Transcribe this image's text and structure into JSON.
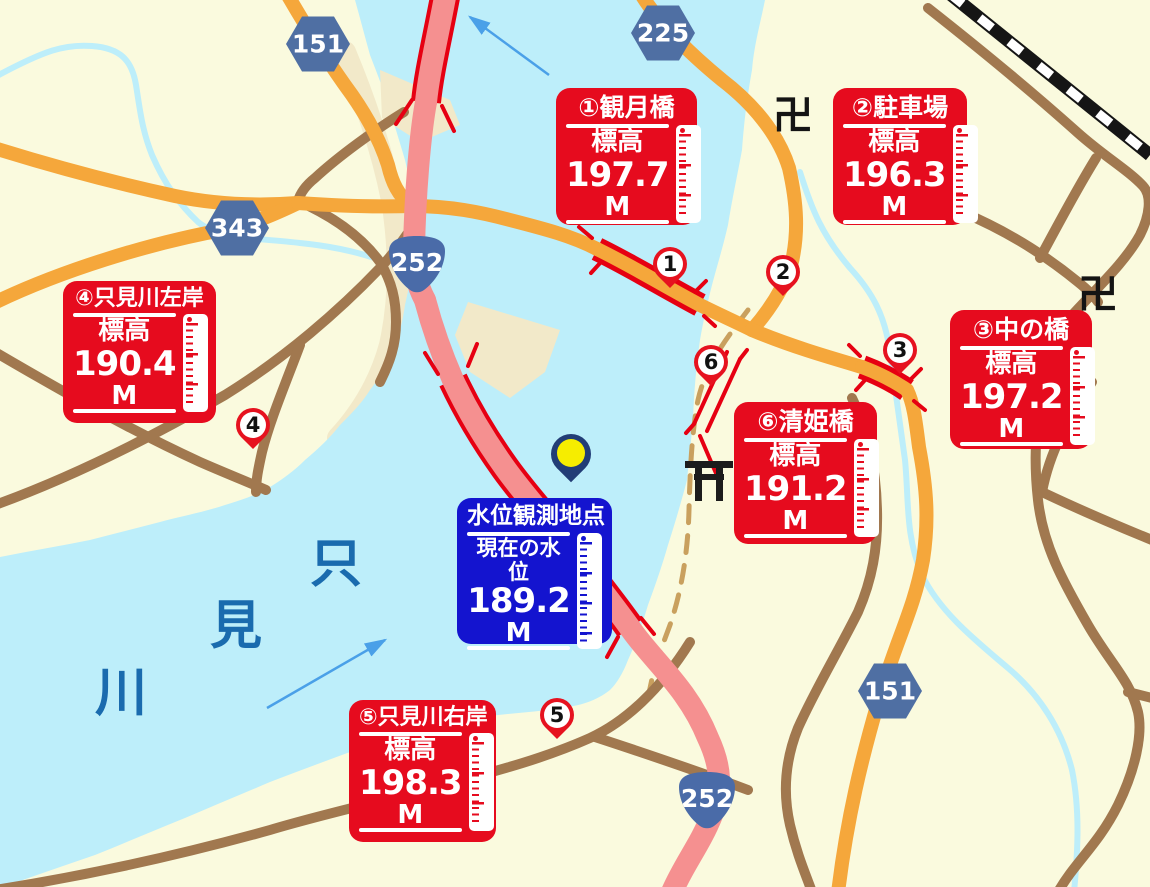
{
  "legend": {
    "stations": [
      {
        "title": "①観月橋",
        "label": "標高",
        "value": "197.7",
        "unit": "M"
      },
      {
        "title": "②駐車場",
        "label": "標高",
        "value": "196.3",
        "unit": "M"
      },
      {
        "title": "③中の橋",
        "label": "標高",
        "value": "197.2",
        "unit": "M"
      },
      {
        "title": "④只見川左岸",
        "label": "標高",
        "value": "190.4",
        "unit": "M"
      },
      {
        "title": "⑤只見川右岸",
        "label": "標高",
        "value": "198.3",
        "unit": "M"
      },
      {
        "title": "⑥清姫橋",
        "label": "標高",
        "value": "191.2",
        "unit": "M"
      }
    ],
    "observation": {
      "title": "水位観測地点",
      "label": "現在の水位",
      "value": "189.2",
      "unit": "M"
    }
  },
  "pins": [
    {
      "number": "1"
    },
    {
      "number": "2"
    },
    {
      "number": "3"
    },
    {
      "number": "4"
    },
    {
      "number": "5"
    },
    {
      "number": "6"
    }
  ],
  "road_badges": [
    {
      "shape": "hexagon",
      "number": "151"
    },
    {
      "shape": "hexagon",
      "number": "225"
    },
    {
      "shape": "hexagon",
      "number": "343"
    },
    {
      "shape": "onigiri",
      "number": "252"
    },
    {
      "shape": "hexagon",
      "number": "151"
    },
    {
      "shape": "onigiri",
      "number": "252"
    }
  ],
  "map_labels": {
    "river_name_chars": [
      "只",
      "見",
      "川"
    ],
    "temple_symbol": "卍"
  },
  "colors": {
    "background": "#fafade",
    "water": "#bdeefa",
    "sandbank": "#f2e9c9",
    "road_orange": "#f5a73b",
    "road_pink": "#f59090",
    "bridge_red": "#e60012",
    "road_brown": "#a1784f",
    "boundary_dash": "#c9a05e",
    "railway": "#151515",
    "station_box": "#e60b1e",
    "observation_box": "#1414cf",
    "badge_blue": "#4f6fa3",
    "river_text": "#1a6bae",
    "flow_arrow": "#4aa0e8",
    "pin_red": "#e6121f",
    "pin_blue_body": "#223d76",
    "pin_blue_dot": "#f6ed00"
  }
}
